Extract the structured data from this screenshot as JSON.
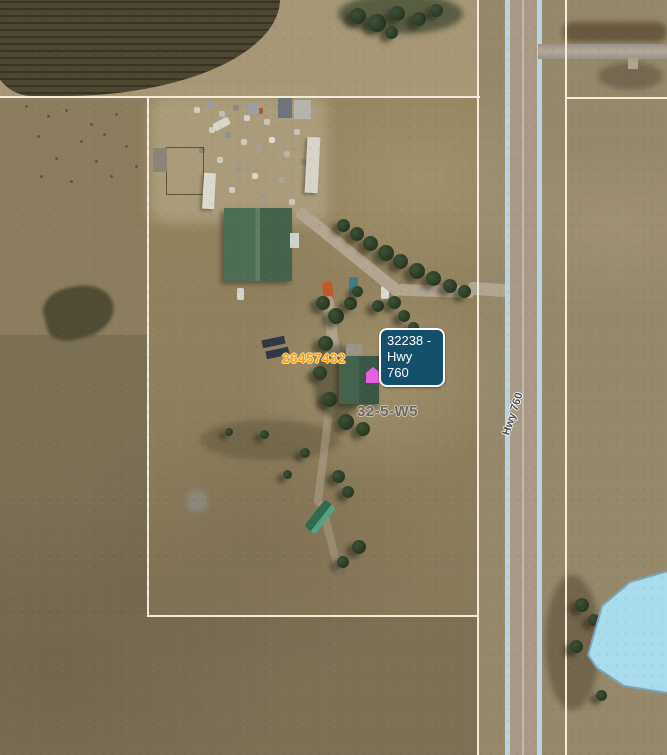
{
  "map": {
    "title": "Aerial parcel map view",
    "callout": {
      "line1": "32238 -",
      "line2": "Hwy 760"
    },
    "labels": {
      "parcel_number": "26457432",
      "quarter_section": "32-5-W5",
      "highway_name": "Hwy 760"
    },
    "features": {
      "selected_parcel_marker": "magenta-house-marker",
      "water_body": "light-blue-pond-polygon",
      "parcel_boundaries": "cream-white-lines"
    },
    "colors": {
      "callout_bg": "#14506b",
      "callout_border": "#ffffff",
      "callout_text": "#ffffff",
      "parcel_number_color": "#ff9d00",
      "quarter_section_color": "#696763",
      "boundary_line": "#f3ecd9",
      "water_fill": "#a9dced",
      "water_edge": "#7ba6b8",
      "marker_color": "#e561e0",
      "highway_edge_stripe": "#b9d4de"
    }
  }
}
